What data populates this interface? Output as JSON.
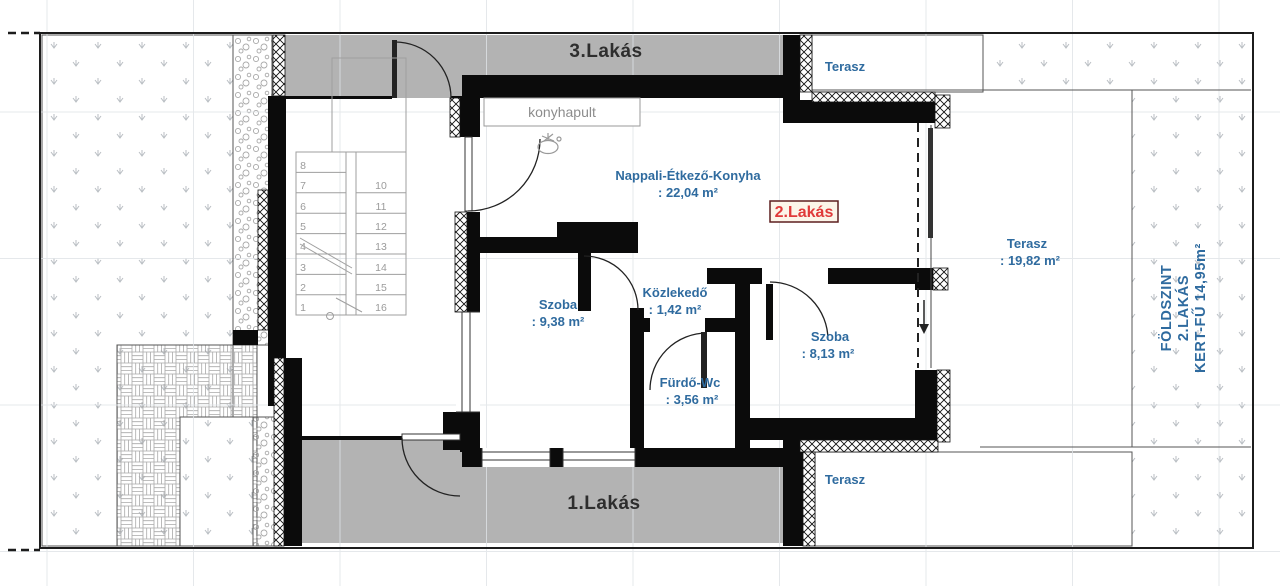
{
  "plan": {
    "unit_labels": {
      "unit3": "3.Lakás",
      "unit1": "1.Lakás",
      "unit2": "2.Lakás"
    },
    "rooms": {
      "nappali": {
        "name": "Nappali-Étkező-Konyha",
        "area": ": 22,04 m²"
      },
      "szoba1": {
        "name": "Szoba",
        "area": ": 9,38 m²"
      },
      "kozlekedo": {
        "name": "Közlekedő",
        "area": ": 1,42 m²"
      },
      "furdo": {
        "name": "Fürdő-Wc",
        "area": ": 3,56 m²"
      },
      "szoba2": {
        "name": "Szoba",
        "area": ": 8,13 m²"
      }
    },
    "terraces": {
      "top": {
        "name": "Terasz"
      },
      "main": {
        "name": "Terasz",
        "area": ": 19,82 m²"
      },
      "bottom": {
        "name": "Terasz"
      }
    },
    "kitchen_counter_label": "konyhapult",
    "garden_note": {
      "line1": "FÖLDSZINT",
      "line2": "2.LAKÁS",
      "line3": "KERT-FŰ 14,95m²"
    },
    "stairs": {
      "left": [
        "8",
        "7",
        "6",
        "5",
        "4",
        "3",
        "2",
        "1"
      ],
      "right": [
        "10",
        "11",
        "12",
        "13",
        "14",
        "15",
        "16"
      ]
    },
    "colors": {
      "room_label_blue": "#2f6b9f",
      "unit_label_dark": "#2e2e2e",
      "unit2_label_red": "#e03a3a",
      "band_gray": "#b3b3b3",
      "wall_black": "#0b0b0b"
    }
  }
}
